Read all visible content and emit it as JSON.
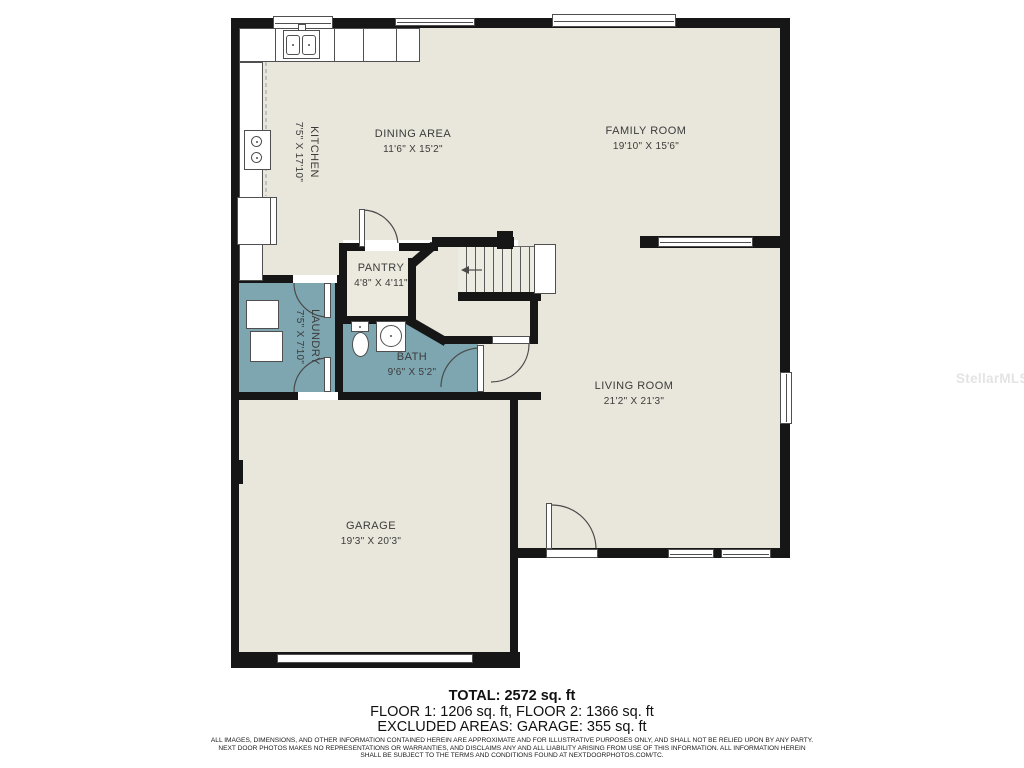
{
  "watermark": "StellarMLS",
  "rooms": {
    "kitchen": {
      "name": "KITCHEN",
      "dims": "7'5\" X 17'10\""
    },
    "dining": {
      "name": "DINING AREA",
      "dims": "11'6\" X 15'2\""
    },
    "family": {
      "name": "FAMILY ROOM",
      "dims": "19'10\" X 15'6\""
    },
    "pantry": {
      "name": "PANTRY",
      "dims": "4'8\" X 4'11\""
    },
    "laundry": {
      "name": "LAUNDRY",
      "dims": "7'5\" X 7'10\""
    },
    "bath": {
      "name": "BATH",
      "dims": "9'6\" X 5'2\""
    },
    "living": {
      "name": "LIVING ROOM",
      "dims": "21'2\" X 21'3\""
    },
    "garage": {
      "name": "GARAGE",
      "dims": "19'3\" X 20'3\""
    }
  },
  "summary": {
    "total": "TOTAL: 2572 sq. ft",
    "floors": "FLOOR 1: 1206 sq. ft, FLOOR 2: 1366 sq. ft",
    "excluded": "EXCLUDED AREAS: GARAGE: 355 sq. ft"
  },
  "disclaimer": {
    "line1": "ALL IMAGES, DIMENSIONS, AND OTHER INFORMATION CONTAINED HEREIN ARE APPROXIMATE AND FOR ILLUSTRATIVE PURPOSES ONLY, AND SHALL NOT BE RELIED UPON BY ANY PARTY.",
    "line2": "NEXT DOOR PHOTOS MAKES NO REPRESENTATIONS OR WARRANTIES, AND DISCLAIMS ANY AND ALL LIABILITY ARISING FROM USE OF THIS INFORMATION. ALL INFORMATION HEREIN",
    "line3": "SHALL BE SUBJECT TO THE TERMS AND CONDITIONS FOUND AT NEXTDOORPHOTOS.COM/TC."
  },
  "colors": {
    "room_fill": "#e9e7db",
    "wet_room_fill": "#7da6b1",
    "wall": "#161616"
  }
}
